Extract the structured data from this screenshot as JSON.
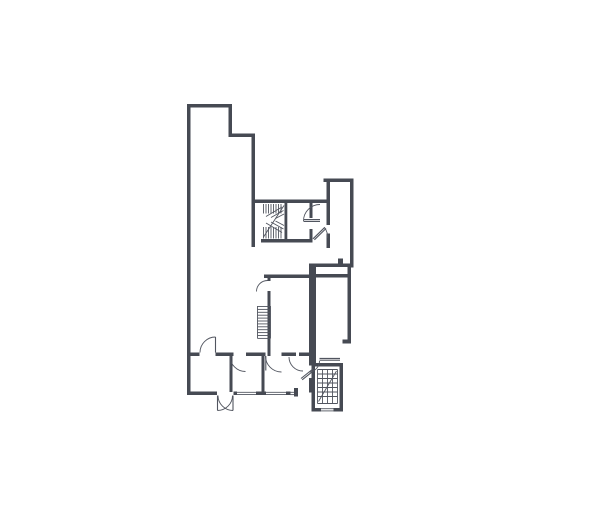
{
  "canvas": {
    "width": 605,
    "height": 530,
    "background": "#ffffff"
  },
  "floorplan": {
    "wall_fill": "#464a53",
    "line_color": "#51555f",
    "line_width": 1.1,
    "thin_width": 0.9,
    "walls": [
      [
        187,
        104,
        3.5,
        291
      ],
      [
        187,
        104,
        45,
        3.5
      ],
      [
        228.5,
        104,
        3.5,
        33
      ],
      [
        228.5,
        133.5,
        26.5,
        3.5
      ],
      [
        251.5,
        133.5,
        3.5,
        113.5
      ],
      [
        251.5,
        199.5,
        78.5,
        3.5
      ],
      [
        323.5,
        178.5,
        30,
        3.5
      ],
      [
        350,
        178.5,
        3.5,
        89
      ],
      [
        326.5,
        182,
        3.5,
        43
      ],
      [
        326.5,
        233.5,
        3.5,
        14.5
      ],
      [
        309.5,
        203,
        3,
        15
      ],
      [
        309.5,
        229,
        3,
        13.5
      ],
      [
        284.5,
        203,
        2.8,
        37.5
      ],
      [
        261,
        239,
        51.5,
        3.5
      ],
      [
        309.5,
        263.5,
        44,
        3.5
      ],
      [
        338,
        258.5,
        5,
        5
      ],
      [
        309,
        263.5,
        7,
        102
      ],
      [
        264,
        274.5,
        45.5,
        3.5
      ],
      [
        316,
        274,
        34,
        3.5
      ],
      [
        267.5,
        274.5,
        3,
        6.5
      ],
      [
        267.5,
        291,
        3,
        65
      ],
      [
        347.5,
        267,
        3.5,
        76.5
      ],
      [
        342.5,
        339.5,
        8.5,
        4
      ],
      [
        190,
        352.5,
        9.5,
        3.5
      ],
      [
        215.5,
        352.5,
        18,
        3.5
      ],
      [
        246,
        352.5,
        19.5,
        3.5
      ],
      [
        281.5,
        352.5,
        14.5,
        3.5
      ],
      [
        299,
        352.5,
        14,
        3.5
      ],
      [
        229.5,
        356,
        3,
        36
      ],
      [
        261.5,
        356,
        3,
        36
      ],
      [
        309,
        378,
        3,
        14.5
      ],
      [
        187,
        391.5,
        30,
        3.5
      ],
      [
        233.5,
        391.5,
        3.5,
        3.5
      ],
      [
        256,
        391.5,
        10,
        3.5
      ],
      [
        286,
        391.5,
        4.5,
        3.5
      ],
      [
        294,
        388,
        4,
        8.5
      ],
      [
        311.5,
        363,
        3.5,
        48.5
      ],
      [
        311.5,
        363,
        31.5,
        3.5
      ],
      [
        339.5,
        363,
        3.5,
        48.5
      ],
      [
        311.5,
        408,
        9.5,
        3.5
      ],
      [
        333.5,
        408,
        9.5,
        3.5
      ]
    ],
    "stair_lines": [
      [
        263.5,
        204,
        263.5,
        213.5
      ],
      [
        266,
        204,
        266,
        213.5
      ],
      [
        268.5,
        204,
        268.5,
        213.5
      ],
      [
        271,
        204,
        271,
        213.5
      ],
      [
        273.5,
        204,
        273.5,
        213.5
      ],
      [
        276,
        204,
        276,
        213.5
      ],
      [
        278.5,
        204,
        278.5,
        213.5
      ],
      [
        281,
        204,
        281,
        213.5
      ],
      [
        263.5,
        227,
        263.5,
        238.5
      ],
      [
        266,
        227,
        266,
        238.5
      ],
      [
        268.5,
        227,
        268.5,
        238.5
      ],
      [
        271,
        227,
        271,
        238.5
      ],
      [
        273.5,
        227,
        273.5,
        238.5
      ],
      [
        276,
        227,
        276,
        238.5
      ],
      [
        278.5,
        227,
        278.5,
        238.5
      ],
      [
        281,
        227,
        281,
        238.5
      ],
      [
        266,
        216.5,
        282,
        207
      ],
      [
        271,
        217.5,
        283.5,
        210.5
      ],
      [
        275.5,
        218.5,
        284,
        214
      ],
      [
        266,
        223,
        282,
        232.5
      ],
      [
        271,
        222,
        283.5,
        229
      ],
      [
        275.5,
        221,
        284,
        225.5
      ],
      [
        263.5,
        237,
        284,
        205.5
      ],
      [
        257.5,
        306,
        257.5,
        338.5
      ],
      [
        270.5,
        306,
        270.5,
        338.5
      ],
      [
        257.5,
        306.5,
        270.5,
        306.5
      ],
      [
        257.5,
        309.4,
        270.5,
        309.4
      ],
      [
        257.5,
        312.3,
        270.5,
        312.3
      ],
      [
        257.5,
        315.2,
        270.5,
        315.2
      ],
      [
        257.5,
        318.1,
        270.5,
        318.1
      ],
      [
        257.5,
        321,
        270.5,
        321
      ],
      [
        257.5,
        323.9,
        270.5,
        323.9
      ],
      [
        257.5,
        326.8,
        270.5,
        326.8
      ],
      [
        257.5,
        329.7,
        270.5,
        329.7
      ],
      [
        257.5,
        332.6,
        270.5,
        332.6
      ],
      [
        257.5,
        335.5,
        270.5,
        335.5
      ],
      [
        257.5,
        338.4,
        270.5,
        338.4
      ],
      [
        317.5,
        369.5,
        337.5,
        369.5
      ],
      [
        317.5,
        403.5,
        337.5,
        403.5
      ],
      [
        317.5,
        369.5,
        317.5,
        403.5
      ],
      [
        337.5,
        369.5,
        337.5,
        403.5
      ],
      [
        322.5,
        369.5,
        322.5,
        403.5
      ],
      [
        327.5,
        369.5,
        327.5,
        403.5
      ],
      [
        332.5,
        369.5,
        332.5,
        403.5
      ],
      [
        317.5,
        374,
        337.5,
        374
      ],
      [
        317.5,
        378.5,
        337.5,
        378.5
      ],
      [
        317.5,
        383,
        337.5,
        383
      ],
      [
        317.5,
        387.5,
        337.5,
        387.5
      ],
      [
        317.5,
        392,
        337.5,
        392
      ],
      [
        317.5,
        396.5,
        337.5,
        396.5
      ],
      [
        318.5,
        401.5,
        336.5,
        371
      ]
    ],
    "window_lines": [
      [
        236.5,
        392.3,
        256,
        392.3
      ],
      [
        236.5,
        394.6,
        256,
        394.6
      ],
      [
        266,
        392.3,
        286,
        392.3
      ],
      [
        266,
        394.6,
        286,
        394.6
      ],
      [
        290,
        392.3,
        294,
        392.3
      ],
      [
        290,
        394.6,
        294,
        394.6
      ],
      [
        321,
        408.7,
        333.5,
        408.7
      ],
      [
        321,
        410.9,
        333.5,
        410.9
      ]
    ],
    "door_leaf_lines": [
      [
        303.5,
        219.6,
        320,
        219.6
      ],
      [
        303.5,
        221.4,
        320,
        221.4
      ],
      [
        313,
        238.8,
        324.8,
        227.3
      ],
      [
        314.4,
        239.8,
        326,
        228.5
      ],
      [
        215.5,
        337,
        215.5,
        352.5
      ],
      [
        230.3,
        356,
        230.3,
        370.5
      ],
      [
        265.8,
        356,
        265.8,
        370.5
      ],
      [
        301,
        378.5,
        313.5,
        368.5
      ],
      [
        302.2,
        379.8,
        314.7,
        369.8
      ],
      [
        319.5,
        358.4,
        340,
        358.4
      ],
      [
        319.5,
        360.2,
        340,
        360.2
      ],
      [
        217.5,
        395.5,
        217.5,
        410.5
      ],
      [
        233,
        395.5,
        233,
        410.5
      ]
    ],
    "door_arcs": [
      "M 303.5 221 A 16.5 16.5 0 0 1 320 204.5",
      "M 324.5 227.5 A 15.5 15.5 0 0 1 327.5 238",
      "M 256.5 291.5 A 11 11 0 0 1 267.5 280.5",
      "M 200 352.5 A 15.5 15.5 0 0 1 215.5 337",
      "M 230 356 A 15.5 15.5 0 0 0 245.5 371.5",
      "M 265.5 356 A 16 16 0 0 0 281.5 372",
      "M 289 357 A 14 14 0 0 0 303 371",
      "M 319.5 361 A 11 11 0 0 1 309 372",
      "M 232.5 395.5 A 15 15 0 0 1 217.5 410.5",
      "M 218 395.5 A 15 15 0 0 0 233 410.5"
    ]
  }
}
